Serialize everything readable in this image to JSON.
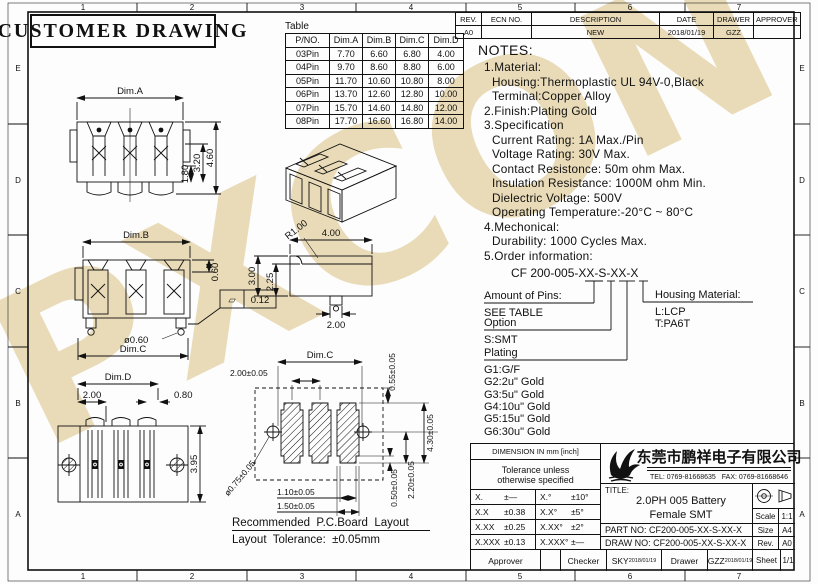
{
  "watermark": "PXCON",
  "frame": {
    "cols": [
      "1",
      "2",
      "3",
      "4",
      "5",
      "6",
      "7"
    ],
    "rows": [
      "E",
      "D",
      "C",
      "B",
      "A"
    ]
  },
  "header": {
    "title": "CUSTOMER DRAWING"
  },
  "rev_table": {
    "headers": [
      "REV.",
      "ECN NO.",
      "DESCRIPTION",
      "DATE",
      "DRAWER",
      "APPROVER"
    ],
    "row": [
      "A0",
      "",
      "NEW",
      "2018/01/19",
      "GZZ",
      ""
    ]
  },
  "dim_table": {
    "caption": "Table",
    "headers": [
      "P/NO.",
      "Dim.A",
      "Dim.B",
      "Dim.C",
      "Dim.D"
    ],
    "rows": [
      [
        "03Pin",
        "7.70",
        "6.60",
        "6.80",
        "4.00"
      ],
      [
        "04Pin",
        "9.70",
        "8.60",
        "8.80",
        "6.00"
      ],
      [
        "05Pin",
        "11.70",
        "10.60",
        "10.80",
        "8.00"
      ],
      [
        "06Pin",
        "13.70",
        "12.60",
        "12.80",
        "10.00"
      ],
      [
        "07Pin",
        "15.70",
        "14.60",
        "14.80",
        "12.00"
      ],
      [
        "08Pin",
        "17.70",
        "16.60",
        "16.80",
        "14.00"
      ]
    ]
  },
  "notes": {
    "heading": "NOTES:",
    "lines": [
      "1.Material:",
      "Housing:Thermoplastic UL 94V-0,Black",
      "Terminal:Copper Alloy",
      "2.Finish:Plating Gold",
      "3.Specification",
      "Current Rating: 1A Max./Pin",
      "Voltage Rating: 30V Max.",
      "Contact Resistonce: 50m ohm Max.",
      "Insulation Resistance: 1000M ohm Min.",
      "Dielectric Voltage: 500V",
      "Operating Temperature:-20°C ~ 80°C",
      "4.Mechonical:",
      "Durability: 1000 Cycles Max.",
      "5.Order information:"
    ]
  },
  "order": {
    "part_code": "CF 200-005-XX-S-XX-X",
    "pins_label": "Amount of Pins:",
    "pins_value": "SEE TABLE",
    "housing_label": "Housing Material:",
    "housing_opt1": "L:LCP",
    "housing_opt2": "T:PA6T",
    "option_label": "Option",
    "option_value": "S:SMT",
    "plating_label": "Plating",
    "plating_opts": [
      "G1:G/F",
      "G2:2u\" Gold",
      "G3:5u\" Gold",
      "G4:10u\" Gold",
      "G5:15u\" Gold",
      "G6:30u\" Gold"
    ]
  },
  "views": {
    "front": {
      "dim_width": "Dim.A",
      "h1": "1.80",
      "h2": "3.20",
      "h3": "4.60"
    },
    "top": {
      "dim_b": "Dim.B",
      "d060": "0.60",
      "flat_sym": "▱",
      "flat_val": "0.12",
      "dia": "ø0.60",
      "dim_c": "Dim.C"
    },
    "bottom": {
      "dim_d": "Dim.D",
      "d200": "2.00",
      "d080": "0.80",
      "d395": "3.95"
    },
    "profile": {
      "r": "R1.00",
      "w": "4.00",
      "h": "3.00",
      "h2": "2.25",
      "pin": "2.00"
    },
    "pcb": {
      "dim_c": "Dim.C",
      "pitch": "2.00±0.05",
      "pad_top": "0.55±0.05",
      "pad_h": "4.30±0.05",
      "hole": "ø0.75±0.05",
      "gap1": "1.10±0.05",
      "gap2": "1.50±0.05",
      "off1": "0.50±0.05",
      "off2": "2.20±0.05",
      "caption1": "Recommended  P.C.Board  Layout",
      "caption2": "Layout  Tolerance:  ±0.05mm"
    }
  },
  "title_block": {
    "dim_header": "DIMENSION IN mm [inch]",
    "tol_line1": "Tolerance unless",
    "tol_line2": "otherwise specified",
    "tol": [
      {
        "l1": "X.",
        "v1": "±—",
        "l2": "X.°",
        "v2": "±10°"
      },
      {
        "l1": "X.X",
        "v1": "±0.38",
        "l2": "X.X°",
        "v2": "±5°"
      },
      {
        "l1": "X.XX",
        "v1": "±0.25",
        "l2": "X.XX°",
        "v2": "±2°"
      },
      {
        "l1": "X.XXX",
        "v1": "±0.13",
        "l2": "X.XXX°",
        "v2": "±—"
      }
    ],
    "company": "东莞市鹏祥电子有限公司",
    "tel": "TEL: 0769-81668635",
    "fax": "FAX: 0769-81668646",
    "title_label": "TITLE:",
    "title_line1": "2.0PH 005 Battery",
    "title_line2": "Female SMT",
    "part_no": "PART  NO: CF200-005-XX-S-XX-X",
    "draw_no": "DRAW  NO: CF200-005-XX-S-XX-X",
    "scale_label": "Scale",
    "scale": "1:1",
    "size_label": "Size",
    "size": "A4",
    "rev_label": "Rev.",
    "rev": "A0",
    "sheet_label": "Sheet",
    "sheet": "1/1",
    "approver_label": "Approver",
    "checker_label": "Checker",
    "checker": "SKY",
    "checker_date": "2018/01/19",
    "drawer_label": "Drawer",
    "drawer": "GZZ",
    "drawer_date": "2018/01/19"
  }
}
